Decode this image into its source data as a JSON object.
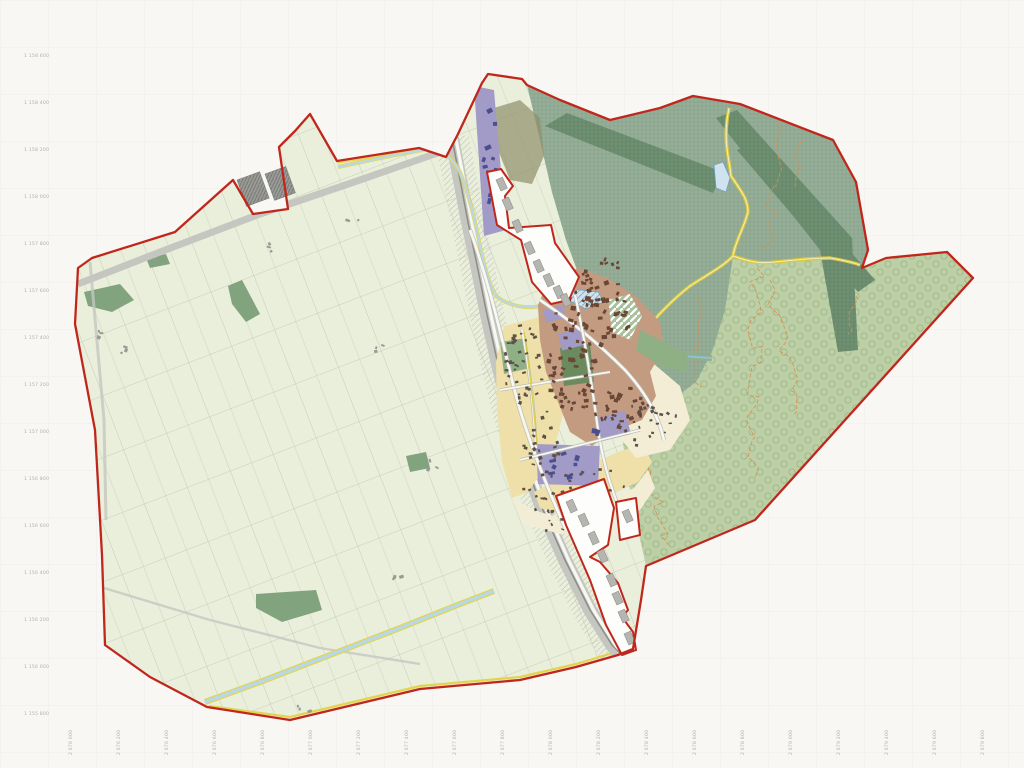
{
  "map": {
    "kind": "municipal-zoning-plan",
    "coordinate_labels": {
      "left": [
        "1 158 600",
        "1 158 400",
        "1 158 200",
        "1 158 000",
        "1 157 800",
        "1 157 600",
        "1 157 400",
        "1 157 200",
        "1 157 000",
        "1 156 800",
        "1 156 600",
        "1 156 400",
        "1 156 200",
        "1 156 000",
        "1 155 800"
      ],
      "bottom": [
        "2 676 000",
        "2 676 200",
        "2 676 400",
        "2 676 600",
        "2 676 800",
        "2 677 000",
        "2 677 200",
        "2 677 400",
        "2 677 600",
        "2 677 800",
        "2 678 000",
        "2 678 200",
        "2 678 400",
        "2 678 600",
        "2 678 800",
        "2 679 000",
        "2 679 200",
        "2 679 400",
        "2 679 600",
        "2 679 800"
      ]
    },
    "regions": {
      "agriculture": "agricultural-zone",
      "forest": "forest-zone",
      "meadow": "meadow-orchard-zone",
      "village_core": "village-core-zone",
      "residential": "residential-zone",
      "public": "public-buildings-zone",
      "excluded": "excluded-enclave"
    },
    "palette": {
      "paper": "#f8f7f4",
      "paper_grid": "#eeedeb",
      "label_gray": "#b3b0ac",
      "boundary_red": "#c0271c",
      "field_green": "#e9efdb",
      "parcel_line": "#b5bba9",
      "road_gray": "#c6c6c1",
      "rail_dark": "#8d8d88",
      "road_white": "#f7f7f3",
      "wood_patch": "#81a37e",
      "forest_base": "#97ae98",
      "forest_hatch": "#82a087",
      "forest_band": "#6f9073",
      "forest_band_hatch": "#5f815f",
      "olive_blob": "#8f8f68",
      "meadow_base": "#bccfa6",
      "meadow_circle": "#9bb680",
      "yellow_road": "#d8c83e",
      "yellow_road_core": "#f4ecbc",
      "contour_orange": "#dd8e4f",
      "water_fill": "#cfe3ef",
      "water_hatch": "#86afd0",
      "water_edge": "#6f9fc0",
      "canal_blue": "#b9d8e6",
      "canal_yellow": "#e3d44e",
      "core_brown": "#c29b80",
      "core_building": "#6a4634",
      "res_yellow": "#eee0a8",
      "res_cream": "#f4edd6",
      "res_building": "#5c5248",
      "purple_zone": "#a29bc7",
      "purple_building": "#4c4f8e",
      "village_green": "#8fb085",
      "village_green_dark": "#6b8b5f",
      "enclave_white": "#fdfdfb",
      "enclave_building": "#b5b5b1",
      "enclave_building_edge": "#8f8f8a",
      "hatch_building": "#9b9b97",
      "hatch_building_line": "#6f6f6b",
      "farm_building": "#9a9a94"
    }
  }
}
